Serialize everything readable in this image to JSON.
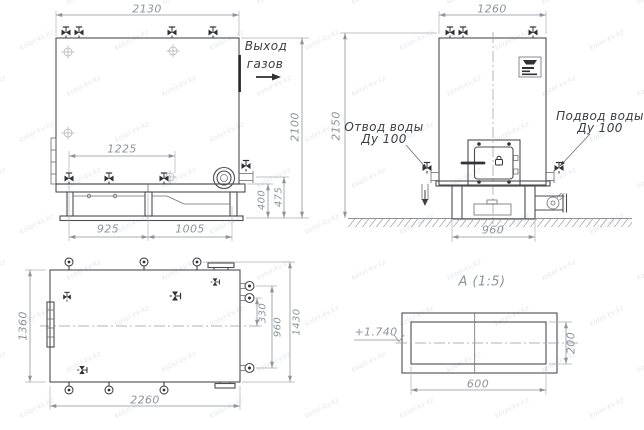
{
  "watermark": {
    "text": "kotel-kv.kz"
  },
  "front": {
    "dim_width": "2130",
    "dim_height": "2100",
    "dim_inner_width": "1225",
    "dim_base_left": "925",
    "dim_base_right": "1005",
    "dim_shelf_height": "400",
    "dim_base_height": "475",
    "label_gas_outlet_1": "Выход",
    "label_gas_outlet_2": "газов"
  },
  "side": {
    "dim_width": "1260",
    "dim_height": "2150",
    "dim_base_width": "960",
    "label_water_outlet_1": "Отвод воды",
    "label_water_outlet_2": "Ду 100",
    "label_water_inlet_1": "Подвод воды",
    "label_water_inlet_2": "Ду 100"
  },
  "plan": {
    "dim_height": "1360",
    "dim_width": "2260",
    "dim_stub_to_center": "330",
    "dim_stub_span": "960",
    "dim_overall": "1430"
  },
  "section": {
    "title": "А  (1:5)",
    "dim_width": "600",
    "dim_height": "200",
    "elevation": "+1.740"
  }
}
